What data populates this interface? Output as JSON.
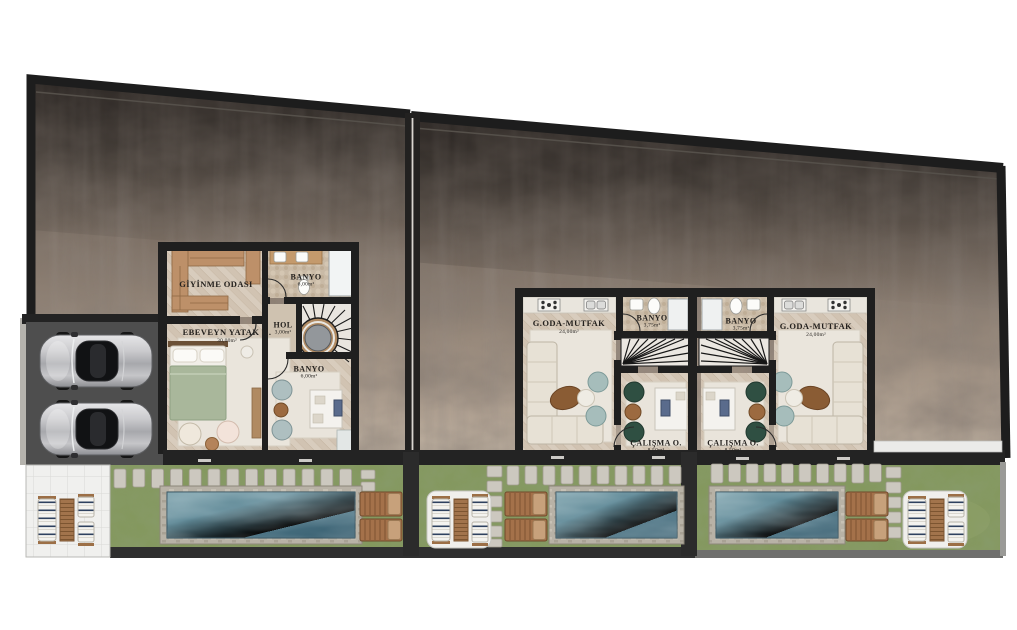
{
  "plan": {
    "left_villa": {
      "dressing_room": {
        "label": "GİYİNME ODASI"
      },
      "bathroom_upper": {
        "label": "BANYO",
        "area": "6,00m²"
      },
      "hall": {
        "label": "HOL",
        "area": "3,00m²"
      },
      "master_bedroom": {
        "label": "EBEVEYN YATAK O.",
        "area": "30,00m²"
      },
      "bathroom_lower": {
        "label": "BANYO",
        "area": "6,00m²"
      }
    },
    "middle_villa": {
      "living_kitchen": {
        "label": "G.ODA-MUTFAK",
        "area": "24,00m²"
      },
      "bathroom": {
        "label": "BANYO",
        "area": "3,75m²"
      },
      "study": {
        "label": "ÇALIŞMA O.",
        "area": "8,50m²"
      }
    },
    "right_villa": {
      "living_kitchen": {
        "label": "G.ODA-MUTFAK",
        "area": "24,00m²"
      },
      "bathroom": {
        "label": "BANYO",
        "area": "3,75m²"
      },
      "study": {
        "label": "ÇALIŞMA O.",
        "area": "8,50m²"
      }
    }
  },
  "colors": {
    "wall": "#1f1f1f",
    "concrete_dark": "#45403d",
    "concrete_light": "#bcaf9f",
    "grass": "#84985e",
    "pool_water": "#4c7889",
    "pool_border": "#b8b2a6",
    "wood_floor": "#d8ccbd"
  }
}
